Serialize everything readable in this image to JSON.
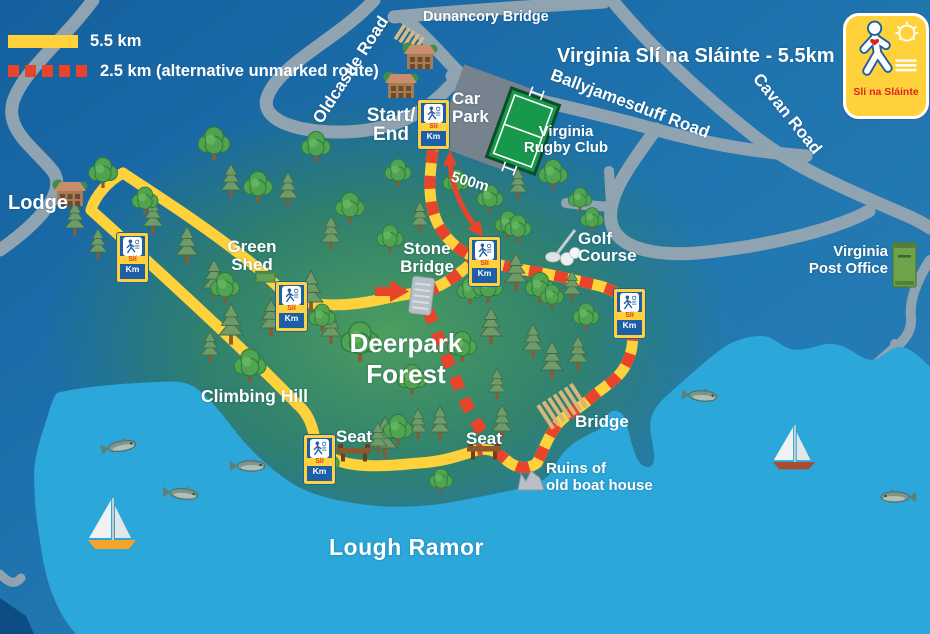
{
  "title": "Virginia Slí na Sláinte - 5.5km",
  "legend": {
    "main_route_label": "5.5 km",
    "alt_route_label": "2.5 km (alternative unmarked route)"
  },
  "logo": {
    "name": "Slí na Sláinte"
  },
  "roads": {
    "oldcastle_road": "Oldcastle Road",
    "dunancory_bridge": "Dunancory Bridge",
    "ballyjamesduff_road": "Ballyjamesduff Road",
    "cavan_road": "Cavan Road"
  },
  "places": {
    "lodge": "Lodge",
    "start_end": "Start/\nEnd",
    "car_park": "Car\nPark",
    "rugby_club": "Virginia\nRugby Club",
    "golf_course": "Golf\nCourse",
    "post_office": "Virginia\nPost Office",
    "green_shed": "Green\nShed",
    "stone_bridge": "Stone\nBridge",
    "deerpark_forest": "Deerpark\nForest",
    "climbing_hill": "Climbing Hill",
    "seat": "Seat",
    "bridge": "Bridge",
    "ruins": "Ruins of\nold boat house",
    "lough_ramor": "Lough Ramor",
    "distance_marker": "500m"
  },
  "km_sign": {
    "sli": "Slí",
    "km": "Km"
  },
  "colors": {
    "route_main": "#FFD23C",
    "route_alt": "#E8442C",
    "water": "#2BA7DA",
    "road": "#8FA3B1",
    "land_blue": "#1E74AD",
    "forest_green": "#3F9560",
    "sign_blue": "#1D5FA6",
    "sign_yellow": "#FFD23C"
  }
}
